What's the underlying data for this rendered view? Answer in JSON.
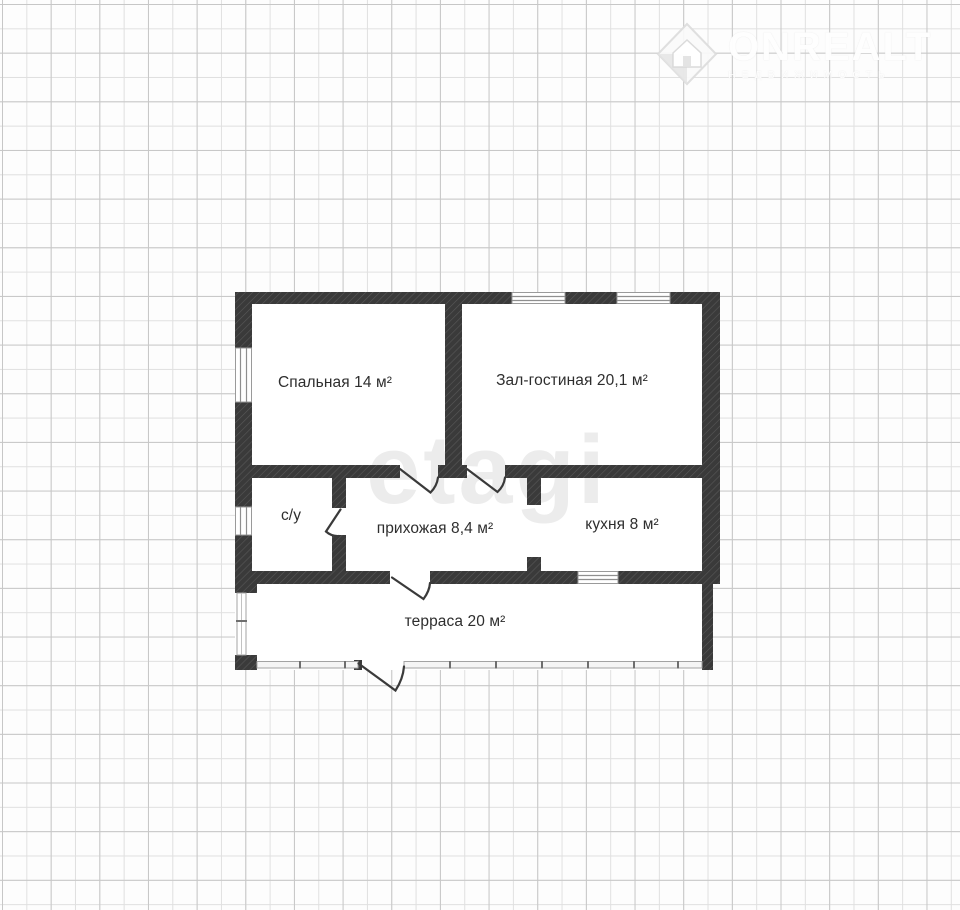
{
  "watermarks": {
    "onrealt": {
      "title": "ONREALT",
      "subtitle": "НЕДВИЖИМОСТЬ",
      "icon": "house-in-diamond"
    },
    "etagi": "etagi"
  },
  "rooms": [
    {
      "id": "bedroom",
      "label": "Спальная 14 м²"
    },
    {
      "id": "living-room",
      "label": "Зал-гостиная 20,1 м²"
    },
    {
      "id": "bathroom",
      "label": "с/у"
    },
    {
      "id": "hallway",
      "label": "прихожая 8,4 м²"
    },
    {
      "id": "kitchen",
      "label": "кухня 8 м²"
    },
    {
      "id": "terrace",
      "label": "терраса 20 м²"
    }
  ],
  "colors": {
    "wall": "#3a3a3a",
    "wall_hatch": "#585858",
    "grid_line": "#c7c7c7",
    "floor": "#ffffff",
    "label_text": "#2e2e2e",
    "railing": "#a3a3a3",
    "etagi_watermark": "#ececec",
    "onrealt_watermark": "#ffffff"
  }
}
